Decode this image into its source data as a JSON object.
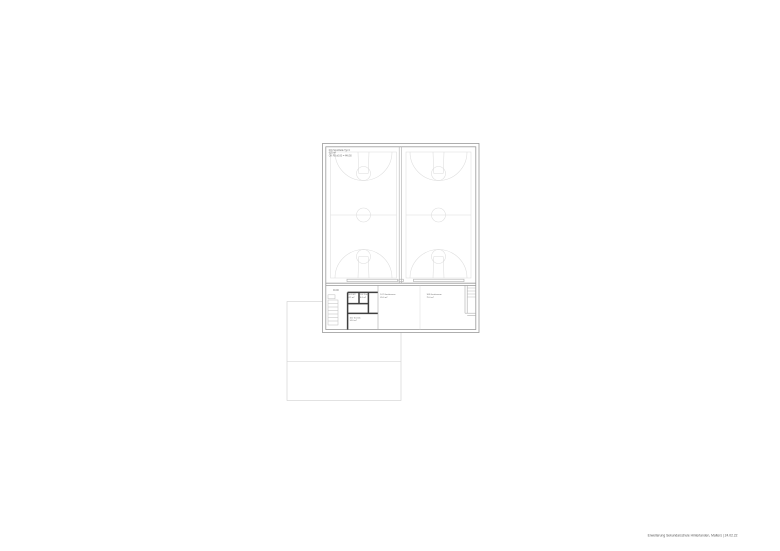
{
  "footer": {
    "caption": "Erweiterung Sekundarschule Hinterlanden, Malters | 24.02.22"
  },
  "plan": {
    "hall_label": {
      "line1": "001 Sporthalle Typ C",
      "line2": "625 m²",
      "line3": "OK FB ±0.00 = 446.50"
    },
    "level_label": "±0.00",
    "room_labels": [
      {
        "name": "101 WC",
        "area": "4.5 m²"
      },
      {
        "name": "102 Putzr.",
        "area": "6.0 m²"
      },
      {
        "name": "107 Geräteraum",
        "area": "65.0 m²"
      },
      {
        "name": "108 Geräteraum",
        "area": "75.0 m²"
      },
      {
        "name": "105 Technik",
        "area": "14.0 m²"
      }
    ],
    "colors": {
      "court_line": "#dcdcdc",
      "exterior_wall": "#9a9a9a",
      "interior_partition": "#3f3f3f",
      "annex_outline": "#cfcfcf",
      "label_text": "#6e6e6e"
    }
  }
}
